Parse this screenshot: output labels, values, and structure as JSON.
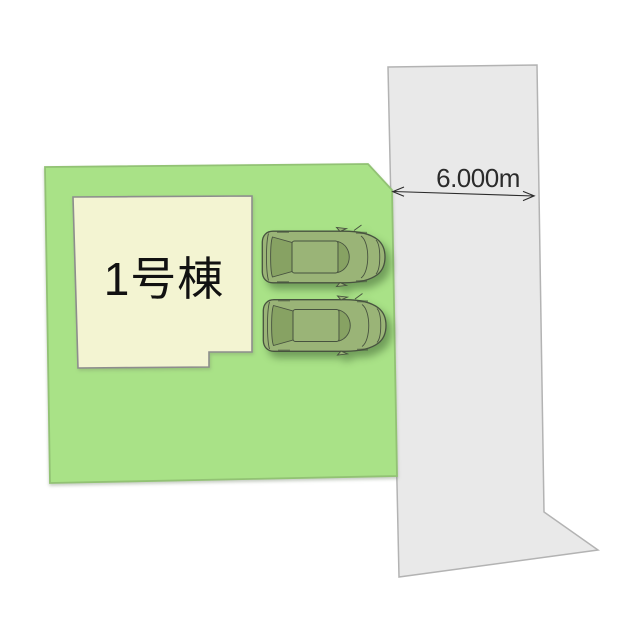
{
  "site_plan": {
    "building_label": "1号棟",
    "road_width_label": "6.000m",
    "colors": {
      "lot": "#a9e287",
      "lot_border": "#92c274",
      "building": "#f3f4d2",
      "building_border": "#8d8d8d",
      "road": "#e9e9e9",
      "road_border": "#b3b3b3",
      "car_body": "#9ab477",
      "car_glass": "#87a263",
      "car_outline": "#47523f",
      "dimension_color": "#2b2b2b",
      "label_color": "#111111"
    }
  }
}
